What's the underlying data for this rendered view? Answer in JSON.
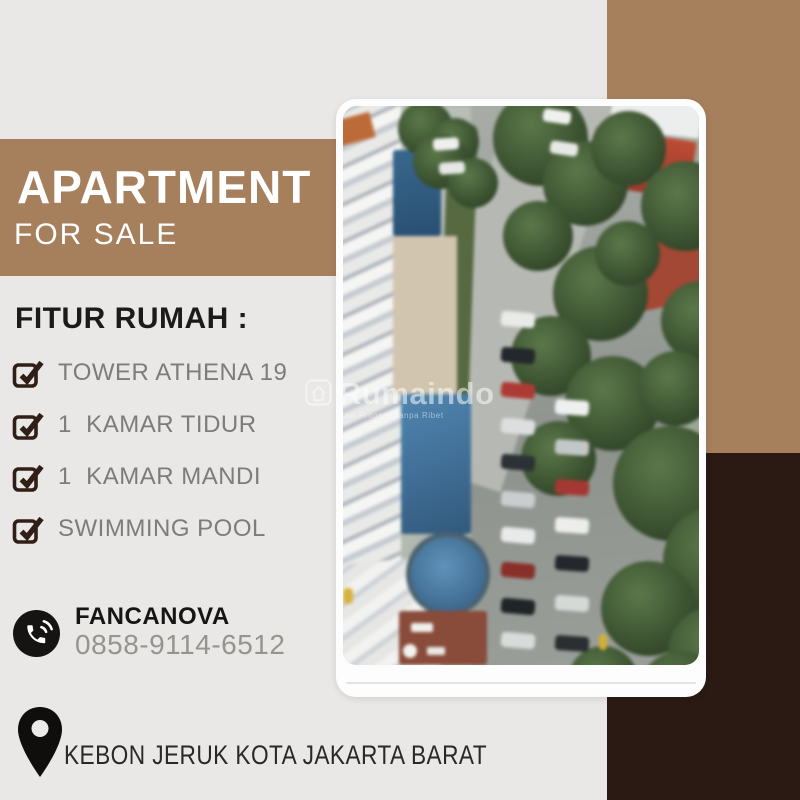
{
  "colors": {
    "background": "#e9e8e6",
    "tan_accent": "#a67f5d",
    "dark_brown": "#2a1a13",
    "checkbox_brown": "#311e17",
    "list_text_grey": "#7d7c7a",
    "white": "#ffffff"
  },
  "banner": {
    "title": "APARTMENT",
    "subtitle": "FOR SALE"
  },
  "features": {
    "heading": "FITUR RUMAH :",
    "items": [
      "TOWER ATHENA 19",
      "1  KAMAR TIDUR",
      "1  KAMAR MANDI",
      "SWIMMING POOL"
    ]
  },
  "contact": {
    "name": "FANCANOVA",
    "phone": "0858-9114-6512"
  },
  "address": {
    "label": "KEBON JERUK KOTA JAKARTA BARAT"
  },
  "watermark": {
    "brand": "Rumaindo",
    "tagline": "Cari Properti Tanpa Ribet"
  },
  "icons": {
    "checkbox": "checkbox-checked-icon",
    "phone": "phone-call-icon",
    "pin": "location-pin-icon",
    "watermark_logo": "house-logo-icon"
  }
}
